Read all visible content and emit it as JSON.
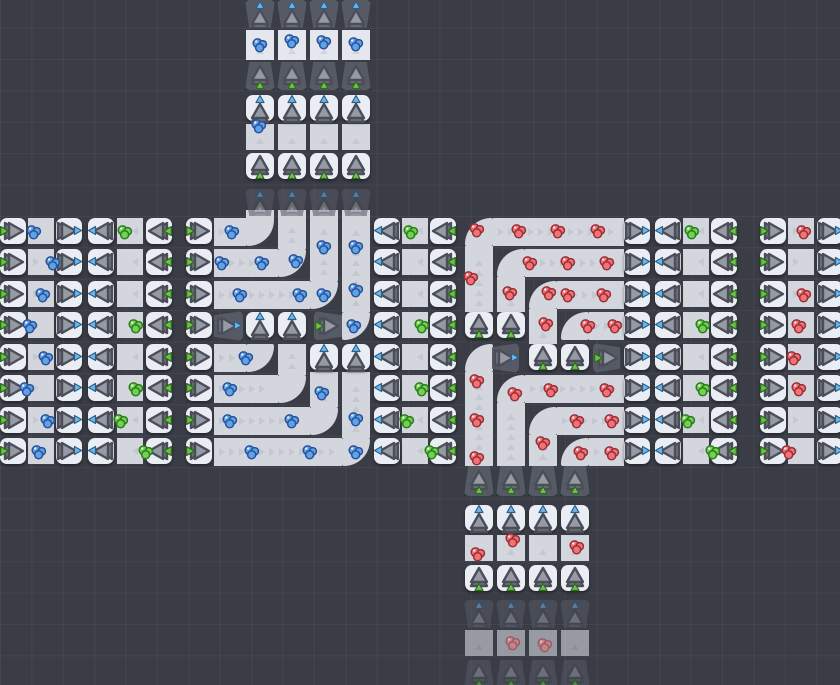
{
  "meta": {
    "width": 840,
    "height": 685,
    "row_ys": [
      218,
      249,
      281,
      312,
      344,
      375,
      407,
      438
    ],
    "faded_opacity": 0.55,
    "colors": {
      "background": "#3a3d46",
      "grid_line": "rgba(255,255,255,0.045)",
      "cap_tile": "#eaedf3",
      "belt": "#d3d6dd",
      "belt_light": "#e4e7ee",
      "bin": "#565a65",
      "chevron": "#b9bcc6",
      "tri_front": "#959aa5",
      "tri_back": "#6e727c",
      "tri_stroke": "#4b4e58",
      "tri_green": "#6cc24d",
      "green_stroke": "#2e6b1d",
      "tri_blue": "#72b6e4",
      "blue_stroke": "#2a5f8f"
    },
    "gem_colors": {
      "b": {
        "fill": "#5ca4e8",
        "edge": "#2d5198"
      },
      "g": {
        "fill": "#72d052",
        "edge": "#2c7d1e"
      },
      "r": {
        "fill": "#f47272",
        "edge": "#97303c"
      }
    }
  },
  "caps": [
    {
      "x": 0,
      "d": "r",
      "k": "e",
      "rows": [
        0,
        1,
        2,
        3,
        4,
        5,
        6,
        7
      ]
    },
    {
      "x": 56,
      "d": "r",
      "k": "r",
      "rows": [
        0,
        1,
        2,
        3,
        4,
        5,
        6,
        7
      ]
    },
    {
      "x": 88,
      "d": "l",
      "k": "r",
      "rows": [
        0,
        1,
        2,
        3,
        4,
        5,
        6,
        7
      ]
    },
    {
      "x": 146,
      "d": "l",
      "k": "e",
      "rows": [
        0,
        1,
        2,
        3,
        4,
        5,
        6,
        7
      ]
    },
    {
      "x": 186,
      "d": "r",
      "k": "e",
      "rows": [
        0,
        1,
        2,
        3,
        4,
        5,
        6,
        7
      ]
    },
    {
      "x": 374,
      "d": "l",
      "k": "r",
      "rows": [
        0,
        1,
        2,
        3,
        4,
        5,
        6,
        7
      ]
    },
    {
      "x": 430,
      "d": "l",
      "k": "e",
      "rows": [
        0,
        1,
        2,
        3,
        4,
        5,
        6,
        7
      ]
    },
    {
      "x": 624,
      "d": "r",
      "k": "r",
      "rows": [
        0,
        1,
        2,
        3,
        4,
        5,
        6,
        7
      ]
    },
    {
      "x": 655,
      "d": "l",
      "k": "r",
      "rows": [
        0,
        1,
        2,
        3,
        4,
        5,
        6,
        7
      ]
    },
    {
      "x": 711,
      "d": "l",
      "k": "e",
      "rows": [
        0,
        1,
        2,
        3,
        4,
        5,
        6,
        7
      ]
    },
    {
      "x": 760,
      "d": "r",
      "k": "e",
      "rows": [
        0,
        1,
        2,
        3,
        4,
        5,
        6,
        7
      ]
    },
    {
      "x": 817,
      "d": "r",
      "k": "r",
      "rows": [
        0,
        1,
        2,
        3,
        4,
        5,
        6,
        7
      ]
    },
    {
      "xs": [
        246,
        278
      ],
      "y": 312,
      "d": "u",
      "k": "r"
    },
    {
      "xs": [
        310,
        342
      ],
      "y": 344,
      "d": "u",
      "k": "r"
    },
    {
      "xs": [
        465,
        497
      ],
      "y": 312,
      "d": "u",
      "k": "e"
    },
    {
      "xs": [
        529,
        561
      ],
      "y": 344,
      "d": "u",
      "k": "e"
    },
    {
      "xs": [
        246,
        278,
        310,
        342
      ],
      "y": 95,
      "d": "u",
      "k": "r"
    },
    {
      "xs": [
        246,
        278,
        310,
        342
      ],
      "y": 153,
      "d": "u",
      "k": "e"
    },
    {
      "xs": [
        465,
        497,
        529,
        561
      ],
      "y": 505,
      "d": "u",
      "k": "r"
    },
    {
      "xs": [
        465,
        497,
        529,
        561
      ],
      "y": 565,
      "d": "u",
      "k": "e"
    }
  ],
  "bins": [
    {
      "xs": [
        245,
        277,
        309,
        341
      ],
      "y": 0,
      "w": 30,
      "h": 28,
      "d": "u",
      "k": "r"
    },
    {
      "xs": [
        245,
        277,
        309,
        341
      ],
      "y": 62,
      "w": 30,
      "h": 28,
      "d": "u",
      "k": "e"
    },
    {
      "xs": [
        245,
        277,
        309,
        341
      ],
      "y": 189,
      "w": 30,
      "h": 27,
      "d": "u",
      "k": "r",
      "f": 1
    },
    {
      "x": 214,
      "y": 311,
      "w": 29,
      "h": 30,
      "d": "r",
      "k": "r"
    },
    {
      "x": 314,
      "y": 311,
      "w": 28,
      "h": 30,
      "d": "r",
      "k": "e"
    },
    {
      "x": 492,
      "y": 343,
      "w": 27,
      "h": 30,
      "d": "r",
      "k": "r"
    },
    {
      "x": 593,
      "y": 343,
      "w": 27,
      "h": 30,
      "d": "r",
      "k": "e"
    },
    {
      "xs": [
        464,
        496,
        528,
        560
      ],
      "y": 466,
      "w": 30,
      "h": 30,
      "d": "u",
      "k": "e"
    },
    {
      "xs": [
        464,
        496,
        528,
        560
      ],
      "y": 600,
      "w": 30,
      "h": 28,
      "d": "u",
      "k": "r",
      "f": 1
    },
    {
      "xs": [
        464,
        496,
        528,
        560
      ],
      "y": 660,
      "w": 30,
      "h": 28,
      "d": "u",
      "k": "e",
      "f": 1
    }
  ],
  "belts": [
    {
      "x": 28,
      "rows": [
        0,
        1,
        2,
        3,
        4,
        5,
        6,
        7
      ],
      "w": 26,
      "h": 26,
      "d": "r"
    },
    {
      "x": 117,
      "rows": [
        0,
        1,
        2,
        3,
        4,
        5,
        6,
        7
      ],
      "w": 26,
      "h": 26,
      "d": "l"
    },
    {
      "x": 402,
      "rows": [
        0,
        1,
        2,
        3,
        4,
        5,
        6,
        7
      ],
      "w": 26,
      "h": 26,
      "d": "l"
    },
    {
      "x": 683,
      "rows": [
        0,
        1,
        2,
        3,
        4,
        5,
        6,
        7
      ],
      "w": 26,
      "h": 26,
      "d": "l"
    },
    {
      "x": 788,
      "rows": [
        0,
        1,
        2,
        3,
        4,
        5,
        6,
        7
      ],
      "w": 26,
      "h": 26,
      "d": "r"
    },
    {
      "xs": [
        246,
        278,
        310,
        342
      ],
      "y": 30,
      "w": 28,
      "h": 30,
      "d": "u",
      "lt": 1
    },
    {
      "xs": [
        246,
        278,
        310,
        342
      ],
      "y": 124,
      "w": 28,
      "h": 26,
      "d": "u"
    },
    {
      "xs": [
        465,
        497,
        529,
        561
      ],
      "y": 535,
      "w": 28,
      "h": 26,
      "d": "u"
    },
    {
      "xs": [
        465,
        497,
        529,
        561
      ],
      "y": 630,
      "w": 28,
      "h": 26,
      "d": "u",
      "lt": 1,
      "f": 1
    },
    {
      "x": 214,
      "y": 218,
      "w": 32,
      "h": 28,
      "d": "r"
    },
    {
      "x": 214,
      "y": 249,
      "w": 64,
      "h": 28,
      "d": "r"
    },
    {
      "x": 214,
      "y": 281,
      "w": 96,
      "h": 28,
      "d": "r"
    },
    {
      "x": 214,
      "y": 344,
      "w": 32,
      "h": 28,
      "d": "r"
    },
    {
      "x": 214,
      "y": 375,
      "w": 64,
      "h": 28,
      "d": "r"
    },
    {
      "x": 214,
      "y": 407,
      "w": 96,
      "h": 28,
      "d": "r"
    },
    {
      "x": 214,
      "y": 438,
      "w": 128,
      "h": 28,
      "d": "r"
    },
    {
      "xs": [
        246,
        278,
        310,
        342
      ],
      "y": 210,
      "w": 28,
      "h": 9,
      "d": "u"
    },
    {
      "x": 278,
      "y": 218,
      "w": 28,
      "h": 31,
      "d": "u"
    },
    {
      "x": 310,
      "y": 218,
      "w": 28,
      "h": 63,
      "d": "u"
    },
    {
      "x": 342,
      "y": 218,
      "w": 28,
      "h": 94,
      "d": "u"
    },
    {
      "x": 278,
      "y": 344,
      "w": 28,
      "h": 31,
      "d": "u"
    },
    {
      "x": 310,
      "y": 372,
      "w": 28,
      "h": 35,
      "d": "u"
    },
    {
      "x": 342,
      "y": 372,
      "w": 28,
      "h": 66,
      "d": "u"
    },
    {
      "x": 493,
      "y": 218,
      "w": 131,
      "h": 28,
      "d": "r"
    },
    {
      "x": 525,
      "y": 249,
      "w": 99,
      "h": 28,
      "d": "r"
    },
    {
      "x": 557,
      "y": 281,
      "w": 67,
      "h": 28,
      "d": "r"
    },
    {
      "x": 589,
      "y": 312,
      "w": 35,
      "h": 28,
      "d": "r"
    },
    {
      "x": 525,
      "y": 375,
      "w": 99,
      "h": 28,
      "d": "r"
    },
    {
      "x": 557,
      "y": 407,
      "w": 67,
      "h": 28,
      "d": "r"
    },
    {
      "x": 589,
      "y": 438,
      "w": 35,
      "h": 28,
      "d": "r"
    },
    {
      "x": 465,
      "y": 246,
      "w": 28,
      "h": 66,
      "d": "u"
    },
    {
      "x": 497,
      "y": 277,
      "w": 28,
      "h": 35,
      "d": "u"
    },
    {
      "x": 529,
      "y": 309,
      "w": 28,
      "h": 35,
      "d": "u"
    },
    {
      "x": 465,
      "y": 372,
      "w": 28,
      "h": 94,
      "d": "u"
    },
    {
      "x": 497,
      "y": 403,
      "w": 28,
      "h": 63,
      "d": "u"
    },
    {
      "x": 529,
      "y": 435,
      "w": 28,
      "h": 31,
      "d": "u"
    }
  ],
  "curves": [
    {
      "x": 246,
      "y": 218,
      "t": "lu"
    },
    {
      "x": 278,
      "y": 249,
      "t": "lu"
    },
    {
      "x": 310,
      "y": 281,
      "t": "lu"
    },
    {
      "x": 342,
      "y": 312,
      "t": "lu"
    },
    {
      "x": 246,
      "y": 344,
      "t": "lu"
    },
    {
      "x": 278,
      "y": 375,
      "t": "lu"
    },
    {
      "x": 310,
      "y": 407,
      "t": "lu"
    },
    {
      "x": 342,
      "y": 438,
      "t": "lu"
    },
    {
      "x": 465,
      "y": 218,
      "t": "ur"
    },
    {
      "x": 497,
      "y": 249,
      "t": "ur"
    },
    {
      "x": 529,
      "y": 281,
      "t": "ur"
    },
    {
      "x": 561,
      "y": 312,
      "t": "ur"
    },
    {
      "x": 465,
      "y": 344,
      "t": "ur"
    },
    {
      "x": 497,
      "y": 375,
      "t": "ur"
    },
    {
      "x": 529,
      "y": 407,
      "t": "ur"
    },
    {
      "x": 561,
      "y": 438,
      "t": "ur"
    }
  ],
  "gems": [
    {
      "x": 34,
      "y": 232,
      "c": "b"
    },
    {
      "x": 53,
      "y": 263,
      "c": "b"
    },
    {
      "x": 43,
      "y": 295,
      "c": "b"
    },
    {
      "x": 30,
      "y": 326,
      "c": "b"
    },
    {
      "x": 46,
      "y": 358,
      "c": "b"
    },
    {
      "x": 27,
      "y": 389,
      "c": "b"
    },
    {
      "x": 48,
      "y": 421,
      "c": "b"
    },
    {
      "x": 39,
      "y": 452,
      "c": "b"
    },
    {
      "x": 125,
      "y": 232,
      "c": "g"
    },
    {
      "x": 136,
      "y": 326,
      "c": "g"
    },
    {
      "x": 136,
      "y": 389,
      "c": "g"
    },
    {
      "x": 121,
      "y": 421,
      "c": "g"
    },
    {
      "x": 146,
      "y": 452,
      "c": "g"
    },
    {
      "x": 411,
      "y": 232,
      "c": "g"
    },
    {
      "x": 422,
      "y": 326,
      "c": "g"
    },
    {
      "x": 422,
      "y": 389,
      "c": "g"
    },
    {
      "x": 407,
      "y": 421,
      "c": "g"
    },
    {
      "x": 432,
      "y": 452,
      "c": "g"
    },
    {
      "x": 692,
      "y": 232,
      "c": "g"
    },
    {
      "x": 703,
      "y": 326,
      "c": "g"
    },
    {
      "x": 703,
      "y": 389,
      "c": "g"
    },
    {
      "x": 688,
      "y": 421,
      "c": "g"
    },
    {
      "x": 713,
      "y": 452,
      "c": "g"
    },
    {
      "x": 804,
      "y": 232,
      "c": "r"
    },
    {
      "x": 804,
      "y": 295,
      "c": "r"
    },
    {
      "x": 799,
      "y": 326,
      "c": "r"
    },
    {
      "x": 794,
      "y": 358,
      "c": "r"
    },
    {
      "x": 799,
      "y": 389,
      "c": "r"
    },
    {
      "x": 789,
      "y": 452,
      "c": "r"
    },
    {
      "x": 232,
      "y": 232,
      "c": "b"
    },
    {
      "x": 296,
      "y": 261,
      "c": "b"
    },
    {
      "x": 222,
      "y": 263,
      "c": "b"
    },
    {
      "x": 262,
      "y": 263,
      "c": "b"
    },
    {
      "x": 324,
      "y": 247,
      "c": "b"
    },
    {
      "x": 324,
      "y": 295,
      "c": "b"
    },
    {
      "x": 240,
      "y": 295,
      "c": "b"
    },
    {
      "x": 300,
      "y": 295,
      "c": "b"
    },
    {
      "x": 356,
      "y": 247,
      "c": "b"
    },
    {
      "x": 356,
      "y": 290,
      "c": "b"
    },
    {
      "x": 354,
      "y": 326,
      "c": "b"
    },
    {
      "x": 246,
      "y": 358,
      "c": "b"
    },
    {
      "x": 230,
      "y": 389,
      "c": "b"
    },
    {
      "x": 322,
      "y": 393,
      "c": "b"
    },
    {
      "x": 356,
      "y": 419,
      "c": "b"
    },
    {
      "x": 230,
      "y": 421,
      "c": "b"
    },
    {
      "x": 292,
      "y": 421,
      "c": "b"
    },
    {
      "x": 252,
      "y": 452,
      "c": "b"
    },
    {
      "x": 310,
      "y": 452,
      "c": "b"
    },
    {
      "x": 356,
      "y": 452,
      "c": "b"
    },
    {
      "x": 477,
      "y": 230,
      "c": "r"
    },
    {
      "x": 519,
      "y": 231,
      "c": "r"
    },
    {
      "x": 558,
      "y": 231,
      "c": "r"
    },
    {
      "x": 598,
      "y": 231,
      "c": "r"
    },
    {
      "x": 471,
      "y": 278,
      "c": "r"
    },
    {
      "x": 530,
      "y": 263,
      "c": "r"
    },
    {
      "x": 568,
      "y": 263,
      "c": "r"
    },
    {
      "x": 607,
      "y": 263,
      "c": "r"
    },
    {
      "x": 510,
      "y": 293,
      "c": "r"
    },
    {
      "x": 549,
      "y": 293,
      "c": "r"
    },
    {
      "x": 568,
      "y": 295,
      "c": "r"
    },
    {
      "x": 604,
      "y": 295,
      "c": "r"
    },
    {
      "x": 546,
      "y": 324,
      "c": "r"
    },
    {
      "x": 588,
      "y": 326,
      "c": "r"
    },
    {
      "x": 615,
      "y": 326,
      "c": "r"
    },
    {
      "x": 477,
      "y": 381,
      "c": "r"
    },
    {
      "x": 477,
      "y": 420,
      "c": "r"
    },
    {
      "x": 477,
      "y": 458,
      "c": "r"
    },
    {
      "x": 515,
      "y": 394,
      "c": "r"
    },
    {
      "x": 551,
      "y": 390,
      "c": "r"
    },
    {
      "x": 607,
      "y": 390,
      "c": "r"
    },
    {
      "x": 543,
      "y": 443,
      "c": "r"
    },
    {
      "x": 577,
      "y": 421,
      "c": "r"
    },
    {
      "x": 612,
      "y": 421,
      "c": "r"
    },
    {
      "x": 581,
      "y": 453,
      "c": "r"
    },
    {
      "x": 612,
      "y": 453,
      "c": "r"
    },
    {
      "x": 260,
      "y": 45,
      "c": "b"
    },
    {
      "x": 292,
      "y": 41,
      "c": "b"
    },
    {
      "x": 324,
      "y": 42,
      "c": "b"
    },
    {
      "x": 356,
      "y": 44,
      "c": "b"
    },
    {
      "x": 259,
      "y": 126,
      "c": "b"
    },
    {
      "x": 478,
      "y": 554,
      "c": "r"
    },
    {
      "x": 513,
      "y": 540,
      "c": "r"
    },
    {
      "x": 577,
      "y": 547,
      "c": "r"
    },
    {
      "x": 513,
      "y": 643,
      "c": "r",
      "f": 1
    },
    {
      "x": 545,
      "y": 645,
      "c": "r",
      "f": 1
    }
  ]
}
